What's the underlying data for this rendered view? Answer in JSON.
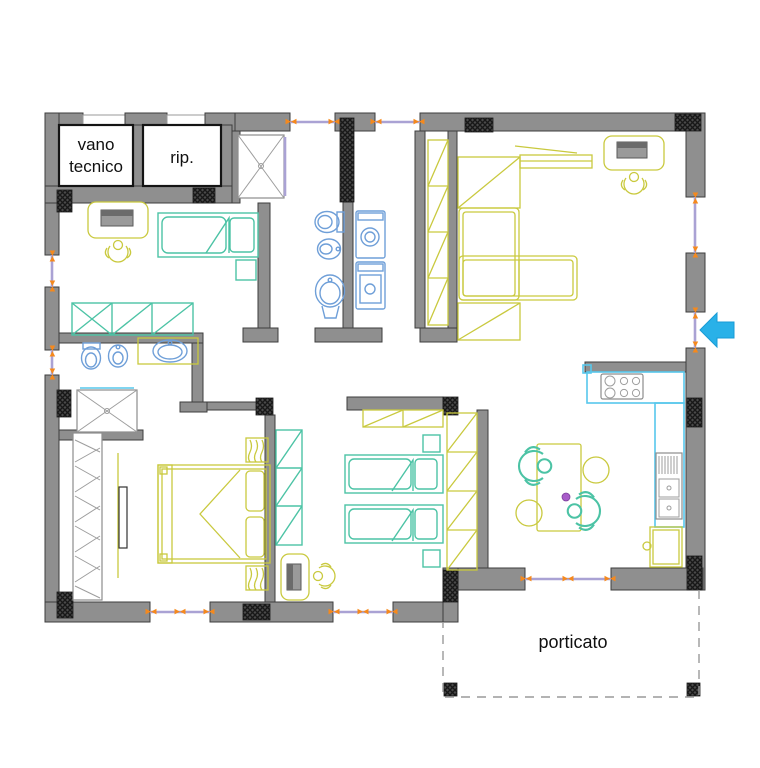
{
  "labels": {
    "vano_tecnico_line1": "vano",
    "vano_tecnico_line2": "tecnico",
    "rip": "rip.",
    "porticato": "porticato"
  },
  "colors": {
    "wall": "#8f8f8f",
    "wall_stroke": "#3d3d3d",
    "teal": "#4cc3a5",
    "olive": "#c9c93e",
    "blue": "#6f9fd8",
    "cyan": "#57c7ec",
    "glass": "#aaa2d4",
    "orange": "#f5891d",
    "arrow": "#29b1e8",
    "dot": "#a85cc9",
    "dash": "#9a9a9a"
  },
  "icons": [
    "single-bed-icon",
    "double-bed-icon",
    "twin-bed-icon",
    "nightstand-icon",
    "wardrobe-icon",
    "hanger-wardrobe-icon",
    "desk-icon",
    "desk-chair-person-icon",
    "sofa-icon",
    "tv-icon",
    "shelf-icon",
    "toilet-icon",
    "bidet-icon",
    "washbasin-icon",
    "shower-icon",
    "washer-dryer-icon",
    "hob-icon",
    "kitchen-sink-icon",
    "kitchen-counter-icon",
    "fridge-icon",
    "dining-table-icon",
    "dining-chair-icon",
    "window-icon",
    "door-icon",
    "entrance-arrow-icon",
    "column-icon"
  ]
}
